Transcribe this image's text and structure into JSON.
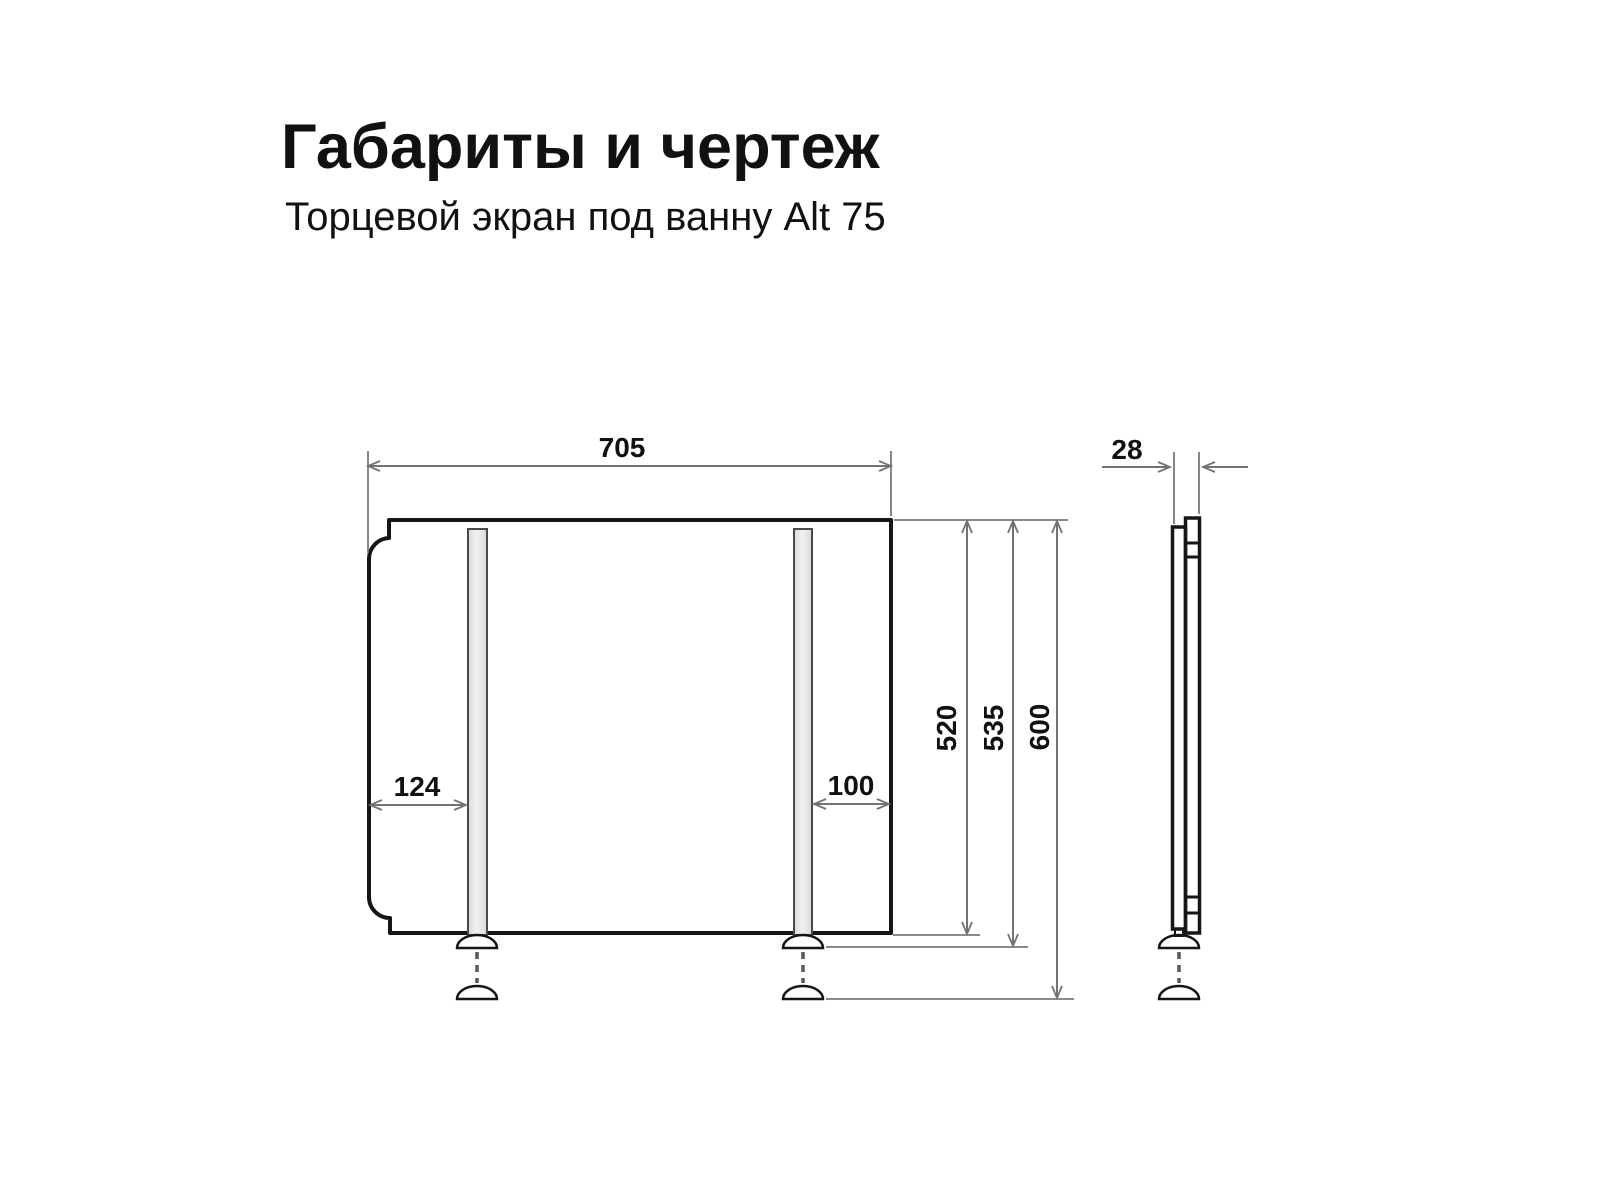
{
  "header": {
    "title": "Габариты и чертеж",
    "subtitle": "Торцевой экран под ванну Alt 75"
  },
  "dimensions": {
    "front_width": "705",
    "left_leg_offset": "124",
    "right_leg_offset": "100",
    "panel_height": "520",
    "height_with_feet": "535",
    "height_max": "600",
    "thickness": "28"
  },
  "colors": {
    "outline": "#1a1a1a",
    "dimension_line": "#737373",
    "panel_fill_light": "#f4f4f4",
    "panel_fill_dark": "#d6d6d6",
    "text": "#111111",
    "background": "#ffffff"
  }
}
